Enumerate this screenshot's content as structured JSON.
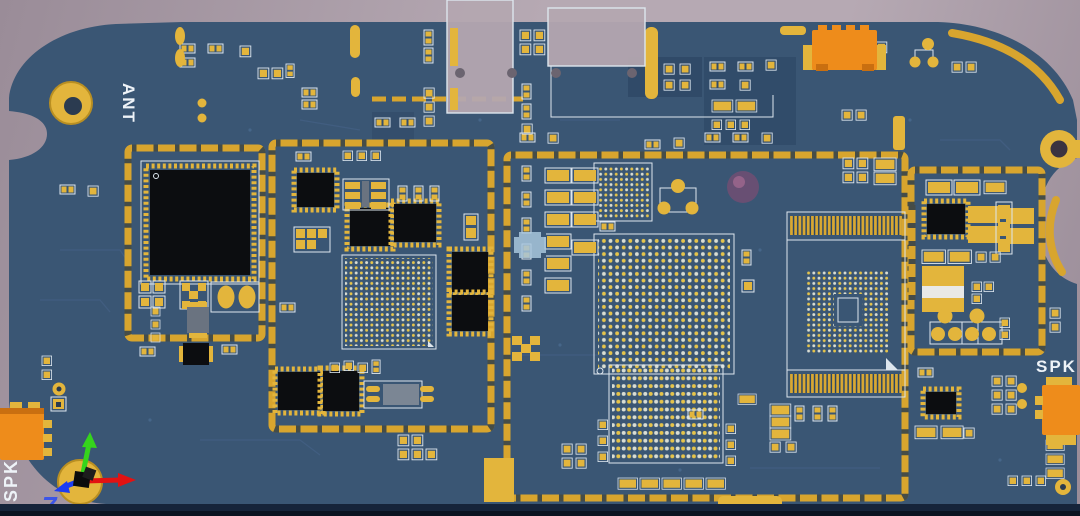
{
  "labels": {
    "antenna": "ANT",
    "speaker_left": "SPK",
    "speaker_right": "SPK",
    "origin_marker": "7"
  },
  "colors": {
    "background_light": "#b6a9b3",
    "background_dark": "#9a8c98",
    "board_blue": "#3a5674",
    "board_dark_panel": "#304a68",
    "board_edge_dark": "#16243a",
    "board_edge_black": "#0b1320",
    "pad_gold": "#e3b53c",
    "shield_gold": "#d8a52e",
    "shield_tick": "#22374e",
    "silkscreen_white": "#dde6ee",
    "ic_black": "#0c0d10",
    "connector_orange": "#ee8c1b",
    "connector_orange_dark": "#c96f10",
    "dot_white": "#d9ddd3",
    "dot_yellow": "#e6c44a",
    "gray_connector": "#b4a7b0",
    "component_gray": "#6a7380",
    "inductor_white": "#e9e9e6",
    "axis_red": "#e31212",
    "axis_green": "#35d41c",
    "axis_blue": "#1d3df2",
    "label_white": "#eef3f8",
    "marker_blue": "#3c55e8",
    "hole_dark": "#2b3b50",
    "sphere_magenta": "#8e4a72"
  }
}
